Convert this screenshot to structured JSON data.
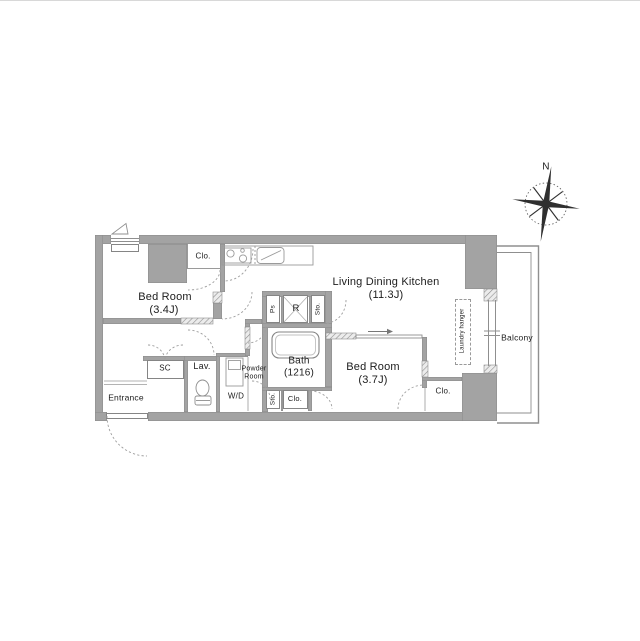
{
  "floorplan": {
    "compass": {
      "north": "N"
    },
    "rooms": {
      "bedroom1": {
        "name": "Bed Room",
        "size": "(3.4J)"
      },
      "bedroom2": {
        "name": "Bed Room",
        "size": "(3.7J)"
      },
      "ldk": {
        "name": "Living Dining Kitchen",
        "size": "(11.3J)"
      },
      "bath": {
        "name": "Bath",
        "size": "(1216)"
      },
      "powder_room": {
        "name": "Powder Room"
      },
      "lavatory": {
        "name": "Lav."
      },
      "entrance": {
        "name": "Entrance"
      },
      "balcony": {
        "name": "Balcony"
      },
      "washer_dryer": {
        "name": "W/D"
      },
      "shoe_closet": {
        "name": "SC"
      }
    },
    "storage": {
      "closet_bedroom1": "Clo.",
      "closet_bedroom2": "Clo.",
      "closet_hall": "Clo.",
      "storage_top": "Sto.",
      "storage_bottom": "Sto.",
      "pipe_space": "Ps",
      "refrigerator": "R"
    },
    "annotations": {
      "laundry_hanger": "Laundry hanger"
    },
    "colors": {
      "wall": "#a3a3a3",
      "outline": "#8a8a8a",
      "dashed_line": "#9f9f9f"
    }
  }
}
